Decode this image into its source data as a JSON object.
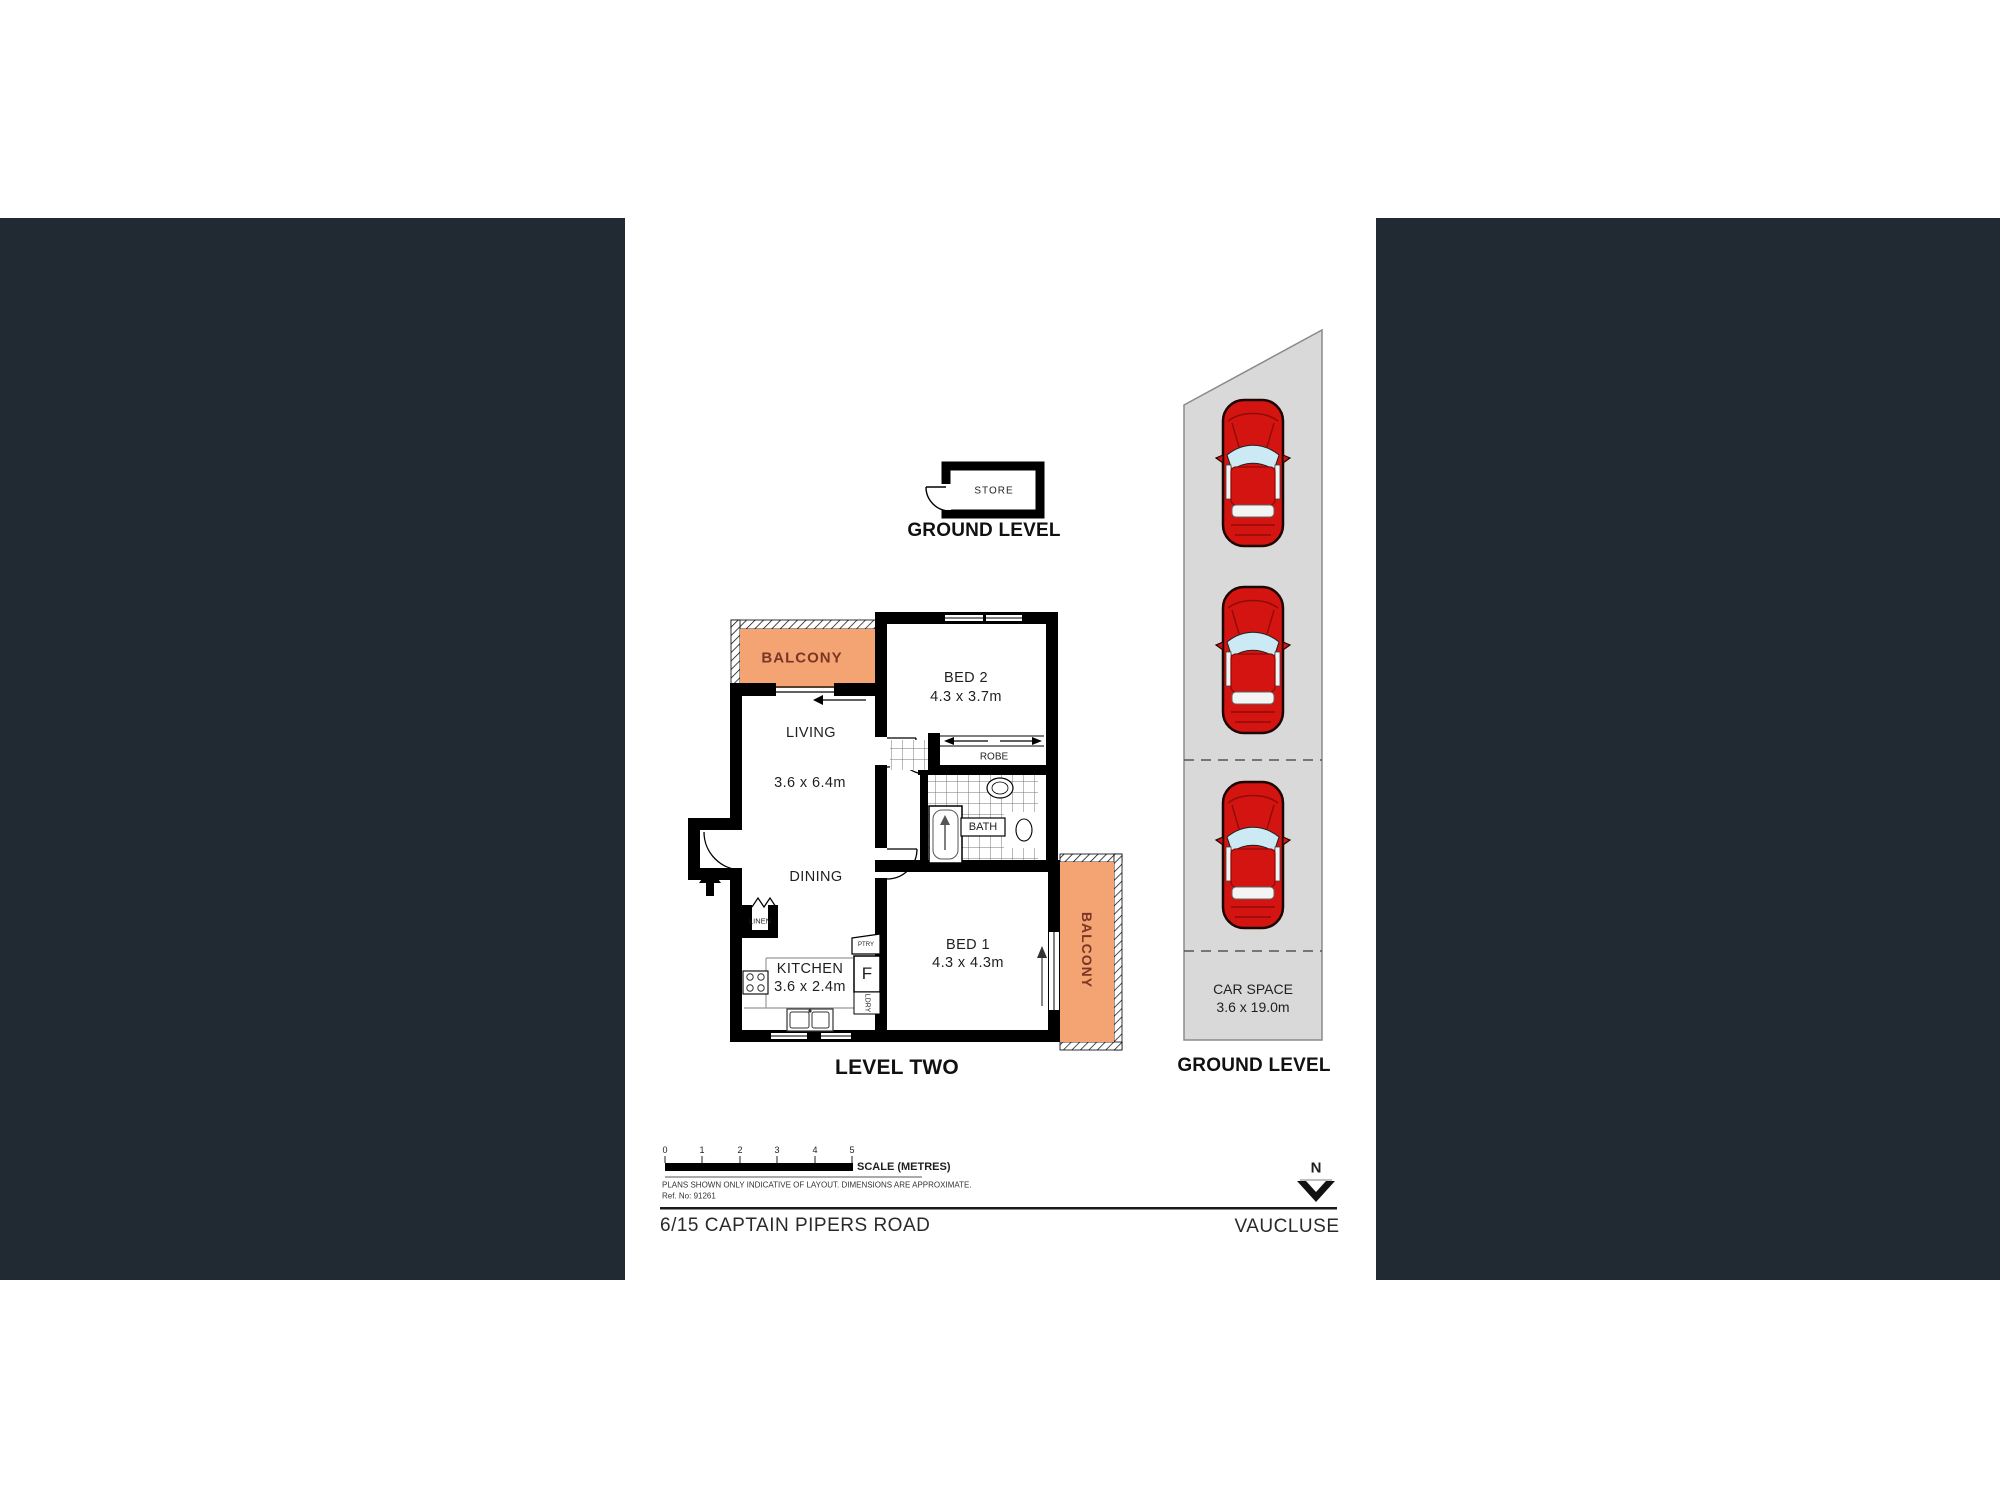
{
  "colors": {
    "panel_dark": "#212A32",
    "balcony_fill": "#F3A472",
    "balcony_text": "#7A3526",
    "car_red": "#D41410",
    "car_glass": "#CBEAF4",
    "carspace_fill": "#D9D9D9",
    "wall": "#000000"
  },
  "store_section": {
    "room": "STORE",
    "title": "GROUND LEVEL"
  },
  "level_two": {
    "title": "LEVEL TWO",
    "balcony_top": "BALCONY",
    "living": "LIVING",
    "living_dims": "3.6 x 6.4m",
    "dining": "DINING",
    "bed2": "BED 2",
    "bed2_dims": "4.3 x 3.7m",
    "robe": "ROBE",
    "bath": "BATH",
    "linen": "LINEN",
    "kitchen": "KITCHEN",
    "kitchen_dims": "3.6 x 2.4m",
    "pantry": "PTRY",
    "fridge": "F",
    "laundry": "LDRY",
    "bed1": "BED 1",
    "bed1_dims": "4.3 x 4.3m",
    "balcony_right": "BALCONY"
  },
  "car_area": {
    "label": "CAR SPACE",
    "dims": "3.6 x 19.0m",
    "title": "GROUND LEVEL",
    "car_count": 3
  },
  "scale_bar": {
    "ticks": [
      "0",
      "1",
      "2",
      "3",
      "4",
      "5"
    ],
    "label": "SCALE (METRES)",
    "disclaimer": "PLANS SHOWN ONLY INDICATIVE OF LAYOUT.  DIMENSIONS ARE APPROXIMATE.",
    "ref": "Ref. No: 91261"
  },
  "footer": {
    "address": "6/15 CAPTAIN PIPERS ROAD",
    "suburb": "VAUCLUSE"
  },
  "compass": {
    "north": "N"
  }
}
